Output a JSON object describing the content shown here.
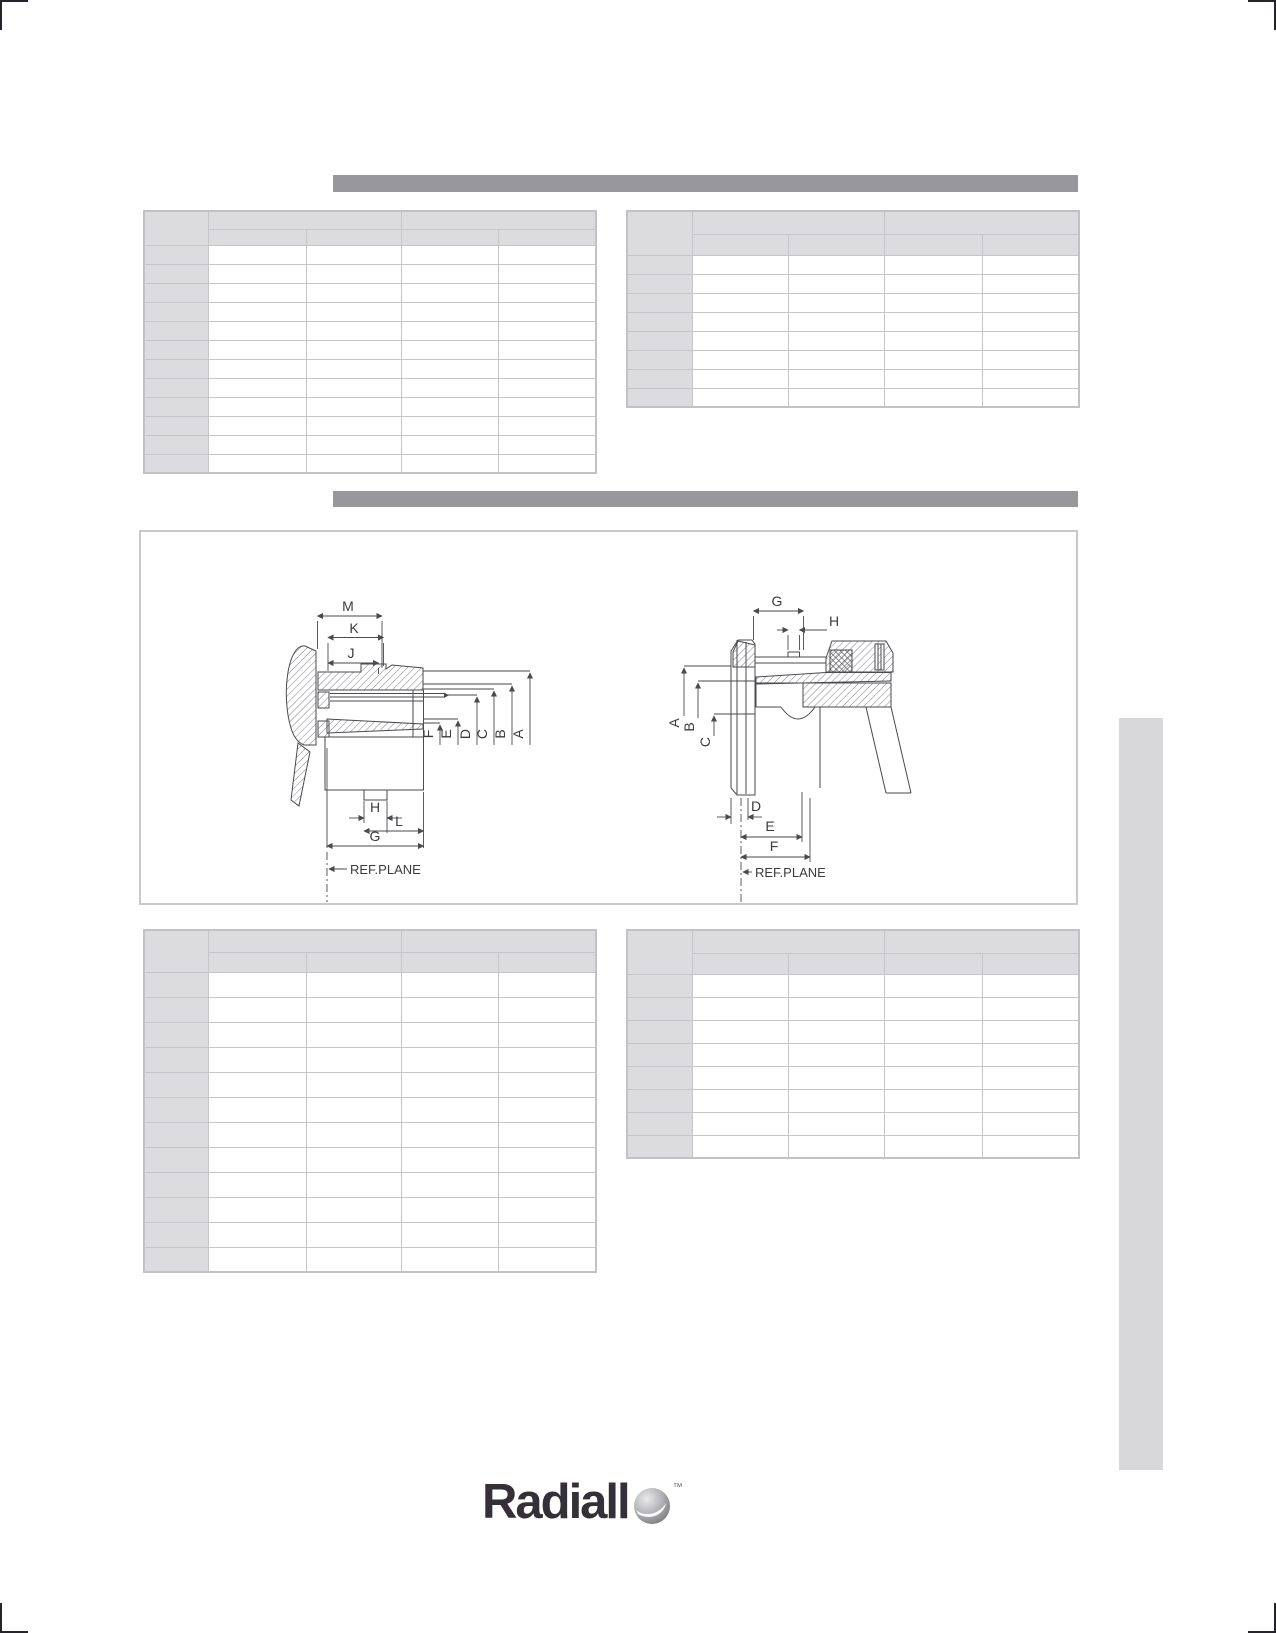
{
  "page": {
    "type": "technical-datasheet-page",
    "visible_text_note": "all table cells and section bars are empty on this page"
  },
  "colors": {
    "section_bar": "#97979c",
    "table_border": "#c6c6ca",
    "table_header_fill": "#dcdcdf",
    "sidebar_fill": "#d8d8da",
    "drawing_line": "#4a4a4f",
    "crop_mark": "#26242a",
    "logo_text": "#353038"
  },
  "section_bars": {
    "bar1": {
      "label": ""
    },
    "bar2": {
      "label": ""
    }
  },
  "tables": {
    "top_left": {
      "col_widths": [
        64,
        98,
        95,
        97,
        98
      ],
      "header1_h": 18,
      "header2_h": 16,
      "row_h": 19,
      "data_rows": 12,
      "corner": "",
      "group1": "",
      "group2": "",
      "subheaders": [
        "",
        "",
        "",
        ""
      ]
    },
    "top_right": {
      "col_widths": [
        65,
        96,
        96,
        98,
        97
      ],
      "header1_h": 23,
      "header2_h": 21,
      "row_h": 19,
      "data_rows": 8,
      "corner": "",
      "group1": "",
      "group2": "",
      "subheaders": [
        "",
        "",
        "",
        ""
      ]
    },
    "bottom_left": {
      "col_widths": [
        64,
        98,
        95,
        97,
        98
      ],
      "header1_h": 22,
      "header2_h": 20,
      "row_h": 25,
      "data_rows": 12,
      "corner": "",
      "group1": "",
      "group2": "",
      "subheaders": [
        "",
        "",
        "",
        ""
      ]
    },
    "bottom_right": {
      "col_widths": [
        65,
        96,
        96,
        98,
        97
      ],
      "header1_h": 23,
      "header2_h": 21,
      "row_h": 23,
      "data_rows": 8,
      "corner": "",
      "group1": "",
      "group2": "",
      "subheaders": [
        "",
        "",
        "",
        ""
      ]
    }
  },
  "drawings": {
    "left": {
      "top_dims": {
        "m": "M",
        "k": "K",
        "j": "J"
      },
      "right_dims": {
        "f": "F",
        "e": "E",
        "d": "D",
        "c": "C",
        "b": "B",
        "a": "A"
      },
      "bottom_dims": {
        "h": "H",
        "l": "L",
        "g": "G"
      },
      "ref_plane": "REF.PLANE"
    },
    "right": {
      "top_dims": {
        "g": "G",
        "h": "H"
      },
      "left_dims": {
        "a": "A",
        "b": "B",
        "c": "C"
      },
      "bottom_dims": {
        "d": "D",
        "e": "E",
        "f": "F"
      },
      "ref_plane": "REF.PLANE"
    }
  },
  "logo": {
    "text": "Radiall",
    "trademark": "™"
  }
}
